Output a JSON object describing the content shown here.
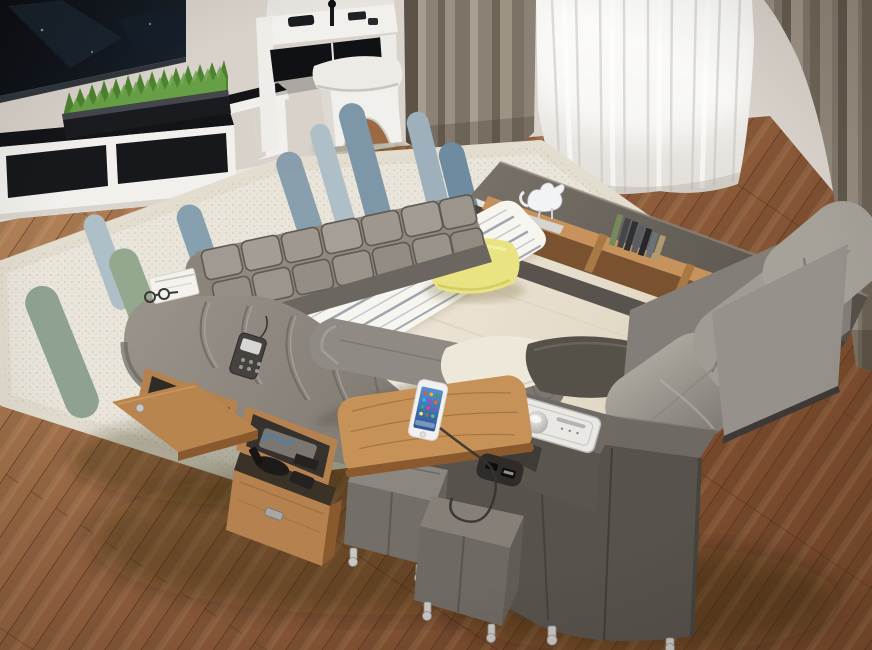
{
  "scene": {
    "title": "High-angle photo of a multifunctional smart storage bed in a modern bedroom",
    "room": "bedroom",
    "view": "high-angle three-quarter"
  },
  "palette": {
    "wall": "#d8d2ca",
    "floor-light": "#b8895c",
    "floor-mid": "#9a6743",
    "floor-dark": "#7c4c2e",
    "plank-seam": "#4a2a14",
    "curtain": "#8b8275",
    "curtain-dark": "#5c5245",
    "curtain-light": "#a59c8d",
    "sheer": "#f2f1ee",
    "rug": "#eae5da",
    "rug-stripe-blue": "#7d97a9",
    "rug-stripe-blue-light": "#aebfc7",
    "rug-stripe-sage": "#93a88f",
    "bed-frame-dark": "#57524c",
    "bed-fabric": "#8f8a84",
    "cushion-gray": "#9d9890",
    "tuft-gray": "#a09a91",
    "mattress-cream": "#efe9dc",
    "mat-white": "#f7f5f0",
    "mat-stripe": "#9fa6ad",
    "pillow-yellow": "#e9e381",
    "pillow-dark": "#565148",
    "wood-oak": "#b5824f",
    "wood-oak-dark": "#8a5a2e",
    "wood-oak-light": "#c8925c",
    "grass-green": "#4d8230",
    "grass-light": "#6ba44a",
    "tv-black": "#0b0e13",
    "white-furniture": "#f2f0ec",
    "black-glass": "#131418",
    "chrome": "#c9c7c3",
    "panel-white": "#e9e8e5",
    "phone-screen": "#3c74b8",
    "cable": "#35322f"
  },
  "objects": [
    {
      "name": "tv",
      "description": "wall-mounted flat screen TV, powered off",
      "color": "tv-black"
    },
    {
      "name": "tv-bench",
      "description": "white media bench with black glass top",
      "color": "white-furniture"
    },
    {
      "name": "media-cabinet",
      "description": "low white TV cabinet with black glass drawers",
      "color": "white-furniture"
    },
    {
      "name": "grass-planter",
      "description": "long black planter with artificial grass",
      "color": "grass-green"
    },
    {
      "name": "vanity-desk",
      "description": "white vanity desk with black glass front and gadgets on top",
      "color": "white-furniture"
    },
    {
      "name": "vanity-stool",
      "description": "white padded stool with arched cutout",
      "color": "white-furniture"
    },
    {
      "name": "curtain-left",
      "description": "taupe drape, left of window",
      "color": "curtain"
    },
    {
      "name": "sheer-curtain",
      "description": "white sheer curtain over bright window",
      "color": "sheer"
    },
    {
      "name": "curtain-right",
      "description": "taupe drape, right of window",
      "color": "curtain"
    },
    {
      "name": "wood-floor",
      "description": "diagonal brown hardwood plank floor",
      "color": "floor-mid"
    },
    {
      "name": "area-rug",
      "description": "cream rug with blue-gray and sage brush-stroke stripes",
      "color": "rug"
    },
    {
      "name": "smart-bed",
      "description": "gray upholstered multifunctional bed with storage",
      "color": "bed-fabric"
    },
    {
      "name": "headboard",
      "description": "angled dark gray headboard wedge",
      "color": "bed-frame-dark"
    },
    {
      "name": "headboard-shelf",
      "description": "built-in oak bookshelf in headboard",
      "color": "wood-oak"
    },
    {
      "name": "cat-figurine",
      "description": "small white cat sculpture on shelf",
      "color": "white-furniture"
    },
    {
      "name": "books",
      "description": "row of books and CDs leaning in shelf",
      "color": "wood-oak-dark"
    },
    {
      "name": "tufted-backrest",
      "description": "tufted square-quilted gray backrest band",
      "color": "tuft-gray"
    },
    {
      "name": "massage-chaise",
      "description": "curved ribbed massage chaise lounge on left side",
      "color": "bed-fabric"
    },
    {
      "name": "bolster-pillow",
      "description": "gray cylindrical bolster cushion",
      "color": "bed-fabric"
    },
    {
      "name": "remote-control",
      "description": "massage remote control lying on chaise",
      "color": "bed-frame-dark"
    },
    {
      "name": "reading-booklet",
      "description": "white folded papers on chaise end",
      "color": "white-furniture"
    },
    {
      "name": "eyeglasses",
      "description": "dark eyeglasses beside booklet",
      "color": "cable"
    },
    {
      "name": "massage-mat",
      "description": "white massage mat with gray pinstripes on mattress",
      "color": "mat-white"
    },
    {
      "name": "yellow-pillow",
      "description": "yellow throw pillow",
      "color": "pillow-yellow"
    },
    {
      "name": "mattress",
      "description": "cream fabric mattress surface",
      "color": "mattress-cream"
    },
    {
      "name": "foot-cushion",
      "description": "small cream cushion near footboard",
      "color": "mattress-cream"
    },
    {
      "name": "dark-pillow",
      "description": "charcoal lumbar pillow near footboard",
      "color": "pillow-dark"
    },
    {
      "name": "right-arm-cushions",
      "description": "row of puffy gray rail cushions on right side",
      "color": "cushion-gray"
    },
    {
      "name": "footboard",
      "description": "dark gray storage footboard box",
      "color": "bed-frame-dark"
    },
    {
      "name": "control-panel",
      "description": "built-in audio control panel with silver knob",
      "color": "panel-white"
    },
    {
      "name": "usb-ports",
      "description": "USB charging ports on footboard side",
      "color": "black-glass"
    },
    {
      "name": "charging-cable",
      "description": "charging cable from phone to USB port",
      "color": "cable"
    },
    {
      "name": "side-table",
      "description": "swivel oak side table attached at foot",
      "color": "wood-oak"
    },
    {
      "name": "smartphone",
      "description": "white smartphone with colorful app grid, charging on table",
      "color": "phone-screen"
    },
    {
      "name": "ottoman-small",
      "description": "small gray cube ottoman with chrome feet",
      "color": "bed-fabric"
    },
    {
      "name": "ottoman-large",
      "description": "large gray cube ottoman with chrome feet",
      "color": "bed-fabric"
    },
    {
      "name": "storage-drawer",
      "description": "pulled-out oak storage drawer with massager inside",
      "color": "wood-oak"
    },
    {
      "name": "storage-niche-appliance",
      "description": "open niche holding white appliance",
      "color": "white-furniture"
    },
    {
      "name": "storage-niche-items",
      "description": "open niche with folded items and cables",
      "color": "wood-oak"
    },
    {
      "name": "fold-out-shelf",
      "description": "fold-out oak side shelf flap",
      "color": "wood-oak"
    }
  ]
}
